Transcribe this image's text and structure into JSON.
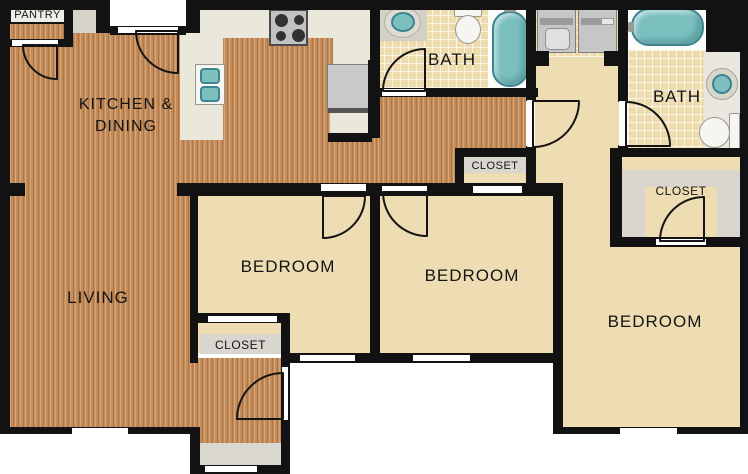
{
  "rooms": {
    "pantry": {
      "label": "PANTRY"
    },
    "kitchen_dining": {
      "line1": "KITCHEN &",
      "line2": "DINING"
    },
    "living": {
      "label": "LIVING"
    },
    "bath_hall": {
      "label": "BATH"
    },
    "bath_master": {
      "label": "BATH"
    },
    "bedroom_left": {
      "label": "BEDROOM"
    },
    "bedroom_middle": {
      "label": "BEDROOM"
    },
    "bedroom_right": {
      "label": "BEDROOM"
    },
    "closet_entry": {
      "label": "CLOSET"
    },
    "closet_hall": {
      "label": "CLOSET"
    },
    "closet_master": {
      "label": "CLOSET"
    }
  },
  "fixtures": {
    "kitchen_sink": "double-basin-sink",
    "stove": "four-burner-stove",
    "refrigerator": "refrigerator",
    "washer": "front-load-washer",
    "dryer": "dryer",
    "bath_hall_sink": "round-sink",
    "bath_hall_toilet": "toilet",
    "bath_hall_tub": "bathtub",
    "bath_master_tub": "bathtub",
    "bath_master_sink": "round-sink",
    "bath_master_toilet": "toilet"
  },
  "colors": {
    "wall": "#121212",
    "wood_floor": "#c38b59",
    "carpet": "#eeddb2",
    "bath_tile": "#eedcae",
    "counter": "#eae7db",
    "closet_gray": "#d9d6cf",
    "fixture_teal": "#7bbfbf",
    "fixture_teal_border": "#3c8590",
    "appliance_gray": "#c6c6c6"
  }
}
